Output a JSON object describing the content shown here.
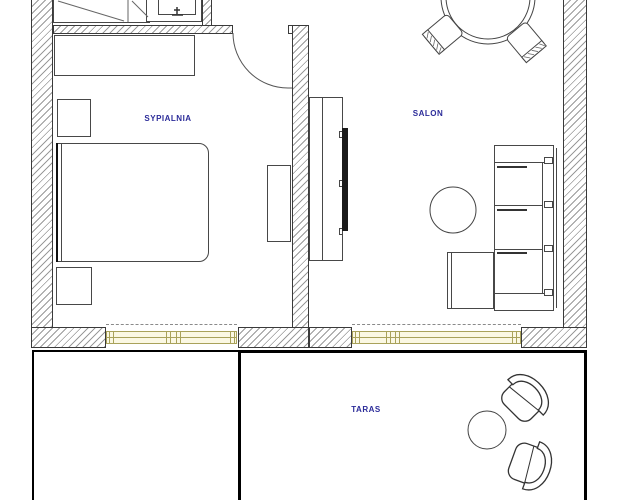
{
  "rooms": {
    "bedroom": {
      "label": "SYPIALNIA"
    },
    "living": {
      "label": "SALON"
    },
    "terrace": {
      "label": "TARAS"
    }
  },
  "colors": {
    "label_text": "#2b2b99",
    "window_fill": "#fbf8e3",
    "window_frame": "#a9a25a",
    "wall_outline": "#3a3a3a",
    "wall_hatch": "#9a9a9a",
    "furniture_line": "#474747",
    "terrace_outline": "#000000",
    "tv_fill": "#1b1b1b"
  },
  "furniture": {
    "bedroom": [
      "wardrobe",
      "washbasin",
      "sideboard",
      "nightstand",
      "double-bed",
      "nightstand",
      "dresser"
    ],
    "living": [
      "round-dining-table",
      "dining-chair",
      "dining-chair",
      "tv-console",
      "tv",
      "sofa",
      "ottoman",
      "round-coffee-table"
    ],
    "terrace": [
      "armchair",
      "armchair",
      "round-side-table"
    ]
  }
}
